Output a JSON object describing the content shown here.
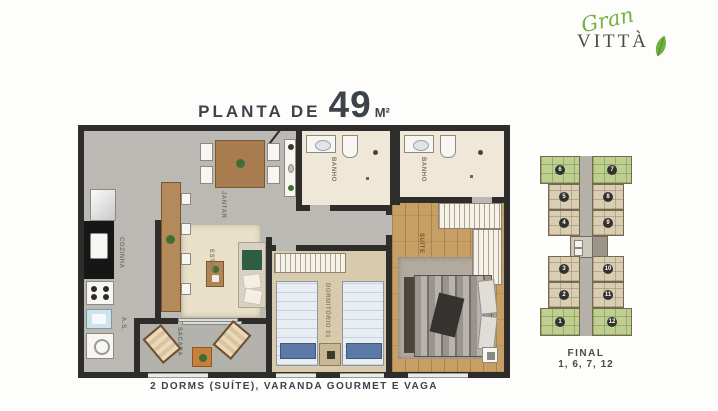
{
  "logo": {
    "script_word": "Gran",
    "brand_word": "VITTÀ"
  },
  "title": {
    "prefix": "PLANTA DE",
    "area_value": "49",
    "area_unit": "M²"
  },
  "caption": "2 DORMS (SUÍTE), VARANDA GOURMET E VAGA",
  "plan": {
    "labels": {
      "jantar": "JANTAR",
      "cozinha": "COZINHA",
      "area_servico": "A.S.",
      "estar": "ESTAR",
      "sacada": "SACADA",
      "dormitorio": "DORMITÓRIO 01",
      "banho_social": "BANHO",
      "banho_suite": "BANHO",
      "suite": "SUÍTE"
    }
  },
  "keyplan": {
    "final_label": "FINAL",
    "final_units": "1, 6, 7, 12",
    "left_units": [
      "6",
      "5",
      "4",
      "3",
      "2",
      "1"
    ],
    "right_units": [
      "7",
      "8",
      "9",
      "10",
      "11",
      "12"
    ],
    "highlighted_units": [
      "1",
      "6",
      "7",
      "12"
    ]
  },
  "colors": {
    "brand_green": "#76b043",
    "wall": "#2e2d2b",
    "wood_floor": "#c79e63",
    "keyplan_unit": "#d9cdb2",
    "keyplan_highlight": "#bdd08f",
    "title_text": "#3c434a"
  }
}
